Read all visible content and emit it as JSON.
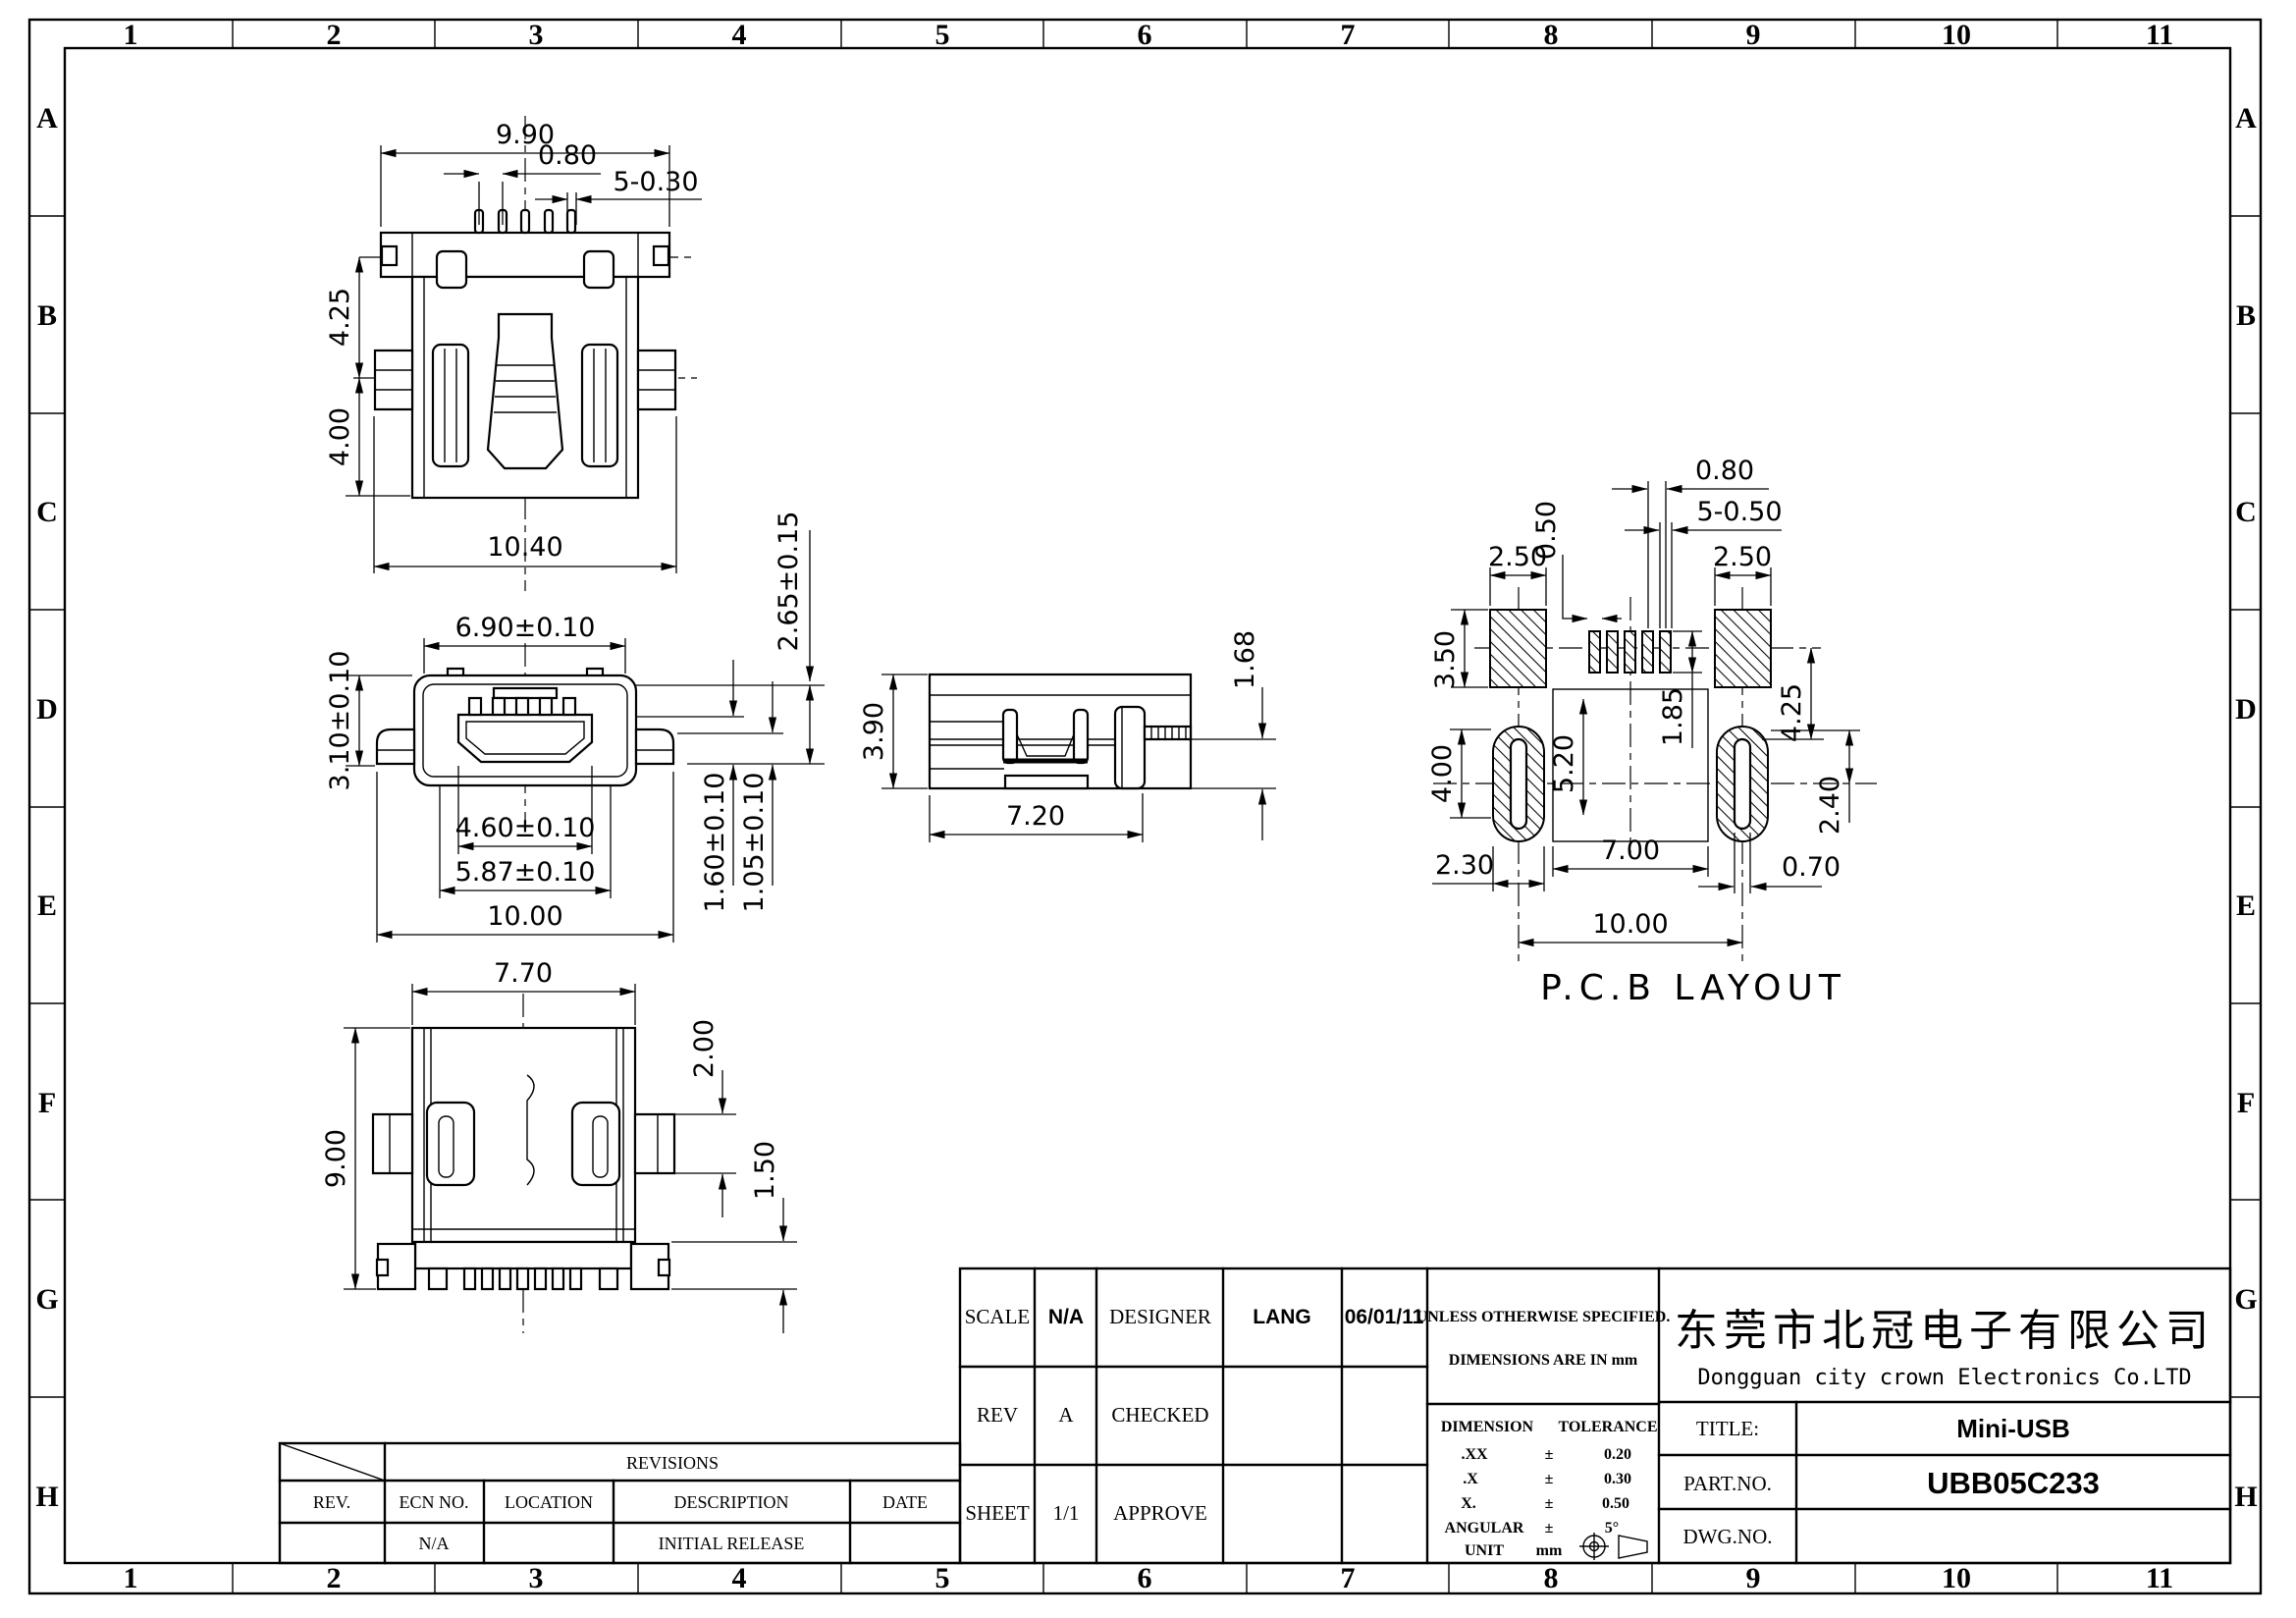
{
  "sheet": {
    "grid_columns": [
      "1",
      "2",
      "3",
      "4",
      "5",
      "6",
      "7",
      "8",
      "9",
      "10",
      "11"
    ],
    "grid_rows": [
      "A",
      "B",
      "C",
      "D",
      "E",
      "F",
      "G",
      "H"
    ]
  },
  "views": {
    "rear": {
      "w_top": "9.90",
      "pitch": "0.80",
      "pins": "5-0.30",
      "h_upper": "4.25",
      "h_lower": "4.00",
      "w_bottom": "10.40"
    },
    "front": {
      "w_top": "6.90±0.10",
      "h_left": "3.10±0.10",
      "w_inner": "4.60±0.10",
      "w_mid": "5.87±0.10",
      "w_total": "10.00",
      "h_r1": "2.65±0.15",
      "h_r2": "1.60±0.10",
      "h_r3": "1.05±0.10"
    },
    "side": {
      "h": "3.90",
      "w": "7.20",
      "pin": "1.68"
    },
    "top": {
      "w": "7.70",
      "h": "9.00",
      "tab": "2.00",
      "foot": "1.50"
    },
    "pcb": {
      "caption": "P.C.B LAYOUT",
      "pitch": "0.80",
      "holes": "5-0.50",
      "pad_w": "0.50",
      "pad_l": "2.50",
      "pad_r": "2.50",
      "pad_len": "3.50",
      "oval_len": "4.00",
      "body_len": "5.20",
      "pin_len": "1.85",
      "row_off": "4.25",
      "oval_off": "2.40",
      "oval_w": "2.30",
      "span_in": "7.00",
      "edge": "0.70",
      "span": "10.00"
    }
  },
  "revisions": {
    "title": "REVISIONS",
    "h_rev": "REV.",
    "h_ecn": "ECN NO.",
    "h_loc": "LOCATION",
    "h_desc": "DESCRIPTION",
    "h_date": "DATE",
    "r_ecn": "N/A",
    "r_desc": "INITIAL RELEASE"
  },
  "tb": {
    "scale_l": "SCALE",
    "scale": "N/A",
    "designer_l": "DESIGNER",
    "designer": "LANG",
    "date": "06/01/11",
    "rev_l": "REV",
    "rev": "A",
    "checked_l": "CHECKED",
    "sheet_l": "SHEET",
    "sheet": "1/1",
    "approve_l": "APPROVE",
    "note1": "UNLESS OTHERWISE SPECIFIED.",
    "note2": "DIMENSIONS ARE IN mm",
    "dim_h": "DIMENSION",
    "tol_h": "TOLERANCE",
    "pm": "±",
    "t1d": ".XX",
    "t1t": "0.20",
    "t2d": ".X",
    "t2t": "0.30",
    "t3d": "X.",
    "t3t": "0.50",
    "t4d": "ANGULAR",
    "t4t": "5°",
    "unit_l": "UNIT",
    "unit": "mm",
    "cn": "东莞市北冠电子有限公司",
    "en": "Dongguan city crown Electronics Co.LTD",
    "title_l": "TITLE:",
    "title": "Mini-USB",
    "part_l": "PART.NO.",
    "part": "UBB05C233",
    "dwg_l": "DWG.NO.",
    "dwg": ""
  }
}
